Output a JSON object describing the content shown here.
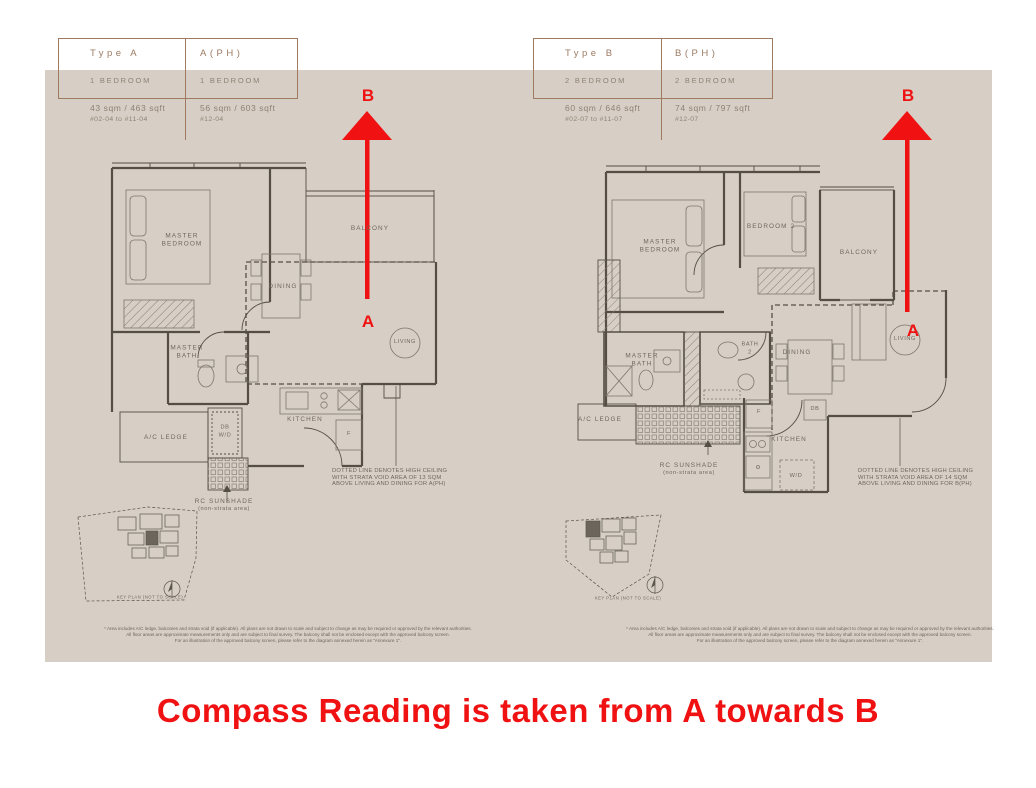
{
  "caption": "Compass Reading is taken from A towards B",
  "compass": {
    "a": "A",
    "b": "B"
  },
  "colors": {
    "panel_bg": "#d7cfc5",
    "red": "#f01212",
    "table_border": "#a07a60",
    "header_text": "#9b7b63",
    "body_text": "#8e8174",
    "plan_line": "#554e45",
    "note_text": "#6f675c"
  },
  "plan_a": {
    "table": {
      "col1": {
        "header": "Type A",
        "bedrooms": "1 BEDROOM",
        "area": "43 sqm / 463 sqft",
        "units": "#02-04 to #11-04"
      },
      "col2": {
        "header": "A(PH)",
        "bedrooms": "1 BEDROOM",
        "area": "56 sqm / 603 sqft",
        "units": "#12-04"
      }
    },
    "labels": {
      "master_bedroom": "MASTER\nBEDROOM",
      "balcony": "BALCONY",
      "dining": "DINING",
      "living": "LIVING",
      "master_bath": "MASTER\nBATH",
      "ac_ledge": "A/C LEDGE",
      "db_wd": "DB\nW/D",
      "kitchen": "KITCHEN",
      "fridge": "F",
      "rc_sunshade": "RC SUNSHADE",
      "rc_sunshade_sub": "(non-strata area)",
      "key_plan": "KEY PLAN (NOT TO SCALE)"
    },
    "note": "DOTTED LINE DENOTES HIGH CEILING\nWITH STRATA VOID AREA OF 13 SQM\nABOVE LIVING AND DINING FOR A(PH)",
    "disclaimer": "* Area includes A/C ledge, balconies and strata void (if applicable). All plans are not drawn to scale and subject to change as may be required or approved by the relevant authorities.\nAll floor areas are approximate measurements only and are subject to final survey. The balcony shall not be enclosed except with the approved balcony screen.\nFor an illustration of the approved balcony screen, please refer to the diagram annexed herein as \"Annexure 1\"."
  },
  "plan_b": {
    "table": {
      "col1": {
        "header": "Type B",
        "bedrooms": "2 BEDROOM",
        "area": "60 sqm / 646 sqft",
        "units": "#02-07 to #11-07"
      },
      "col2": {
        "header": "B(PH)",
        "bedrooms": "2 BEDROOM",
        "area": "74 sqm / 797 sqft",
        "units": "#12-07"
      }
    },
    "labels": {
      "master_bedroom": "MASTER\nBEDROOM",
      "bedroom_2": "BEDROOM 2",
      "balcony": "BALCONY",
      "dining": "DINING",
      "living": "LIVING",
      "master_bath": "MASTER\nBATH",
      "bath_2": "BATH\n2",
      "ac_ledge": "A/C LEDGE",
      "kitchen": "KITCHEN",
      "fridge": "F",
      "db": "DB",
      "wd": "W/D",
      "rc_sunshade": "RC SUNSHADE",
      "rc_sunshade_sub": "(non-strata area)",
      "key_plan": "KEY PLAN (NOT TO SCALE)"
    },
    "note": "DOTTED LINE DENOTES HIGH CEILING\nWITH STRATA VOID AREA OF 14 SQM\nABOVE LIVING AND DINING FOR B(PH)",
    "disclaimer": "* Area includes A/C ledge, balconies and strata void (if applicable). All plans are not drawn to scale and subject to change as may be required or approved by the relevant authorities.\nAll floor areas are approximate measurements only and are subject to final survey. The balcony shall not be enclosed except with the approved balcony screen.\nFor an illustration of the approved balcony screen, please refer to the diagram annexed herein as \"Annexure 1\"."
  }
}
